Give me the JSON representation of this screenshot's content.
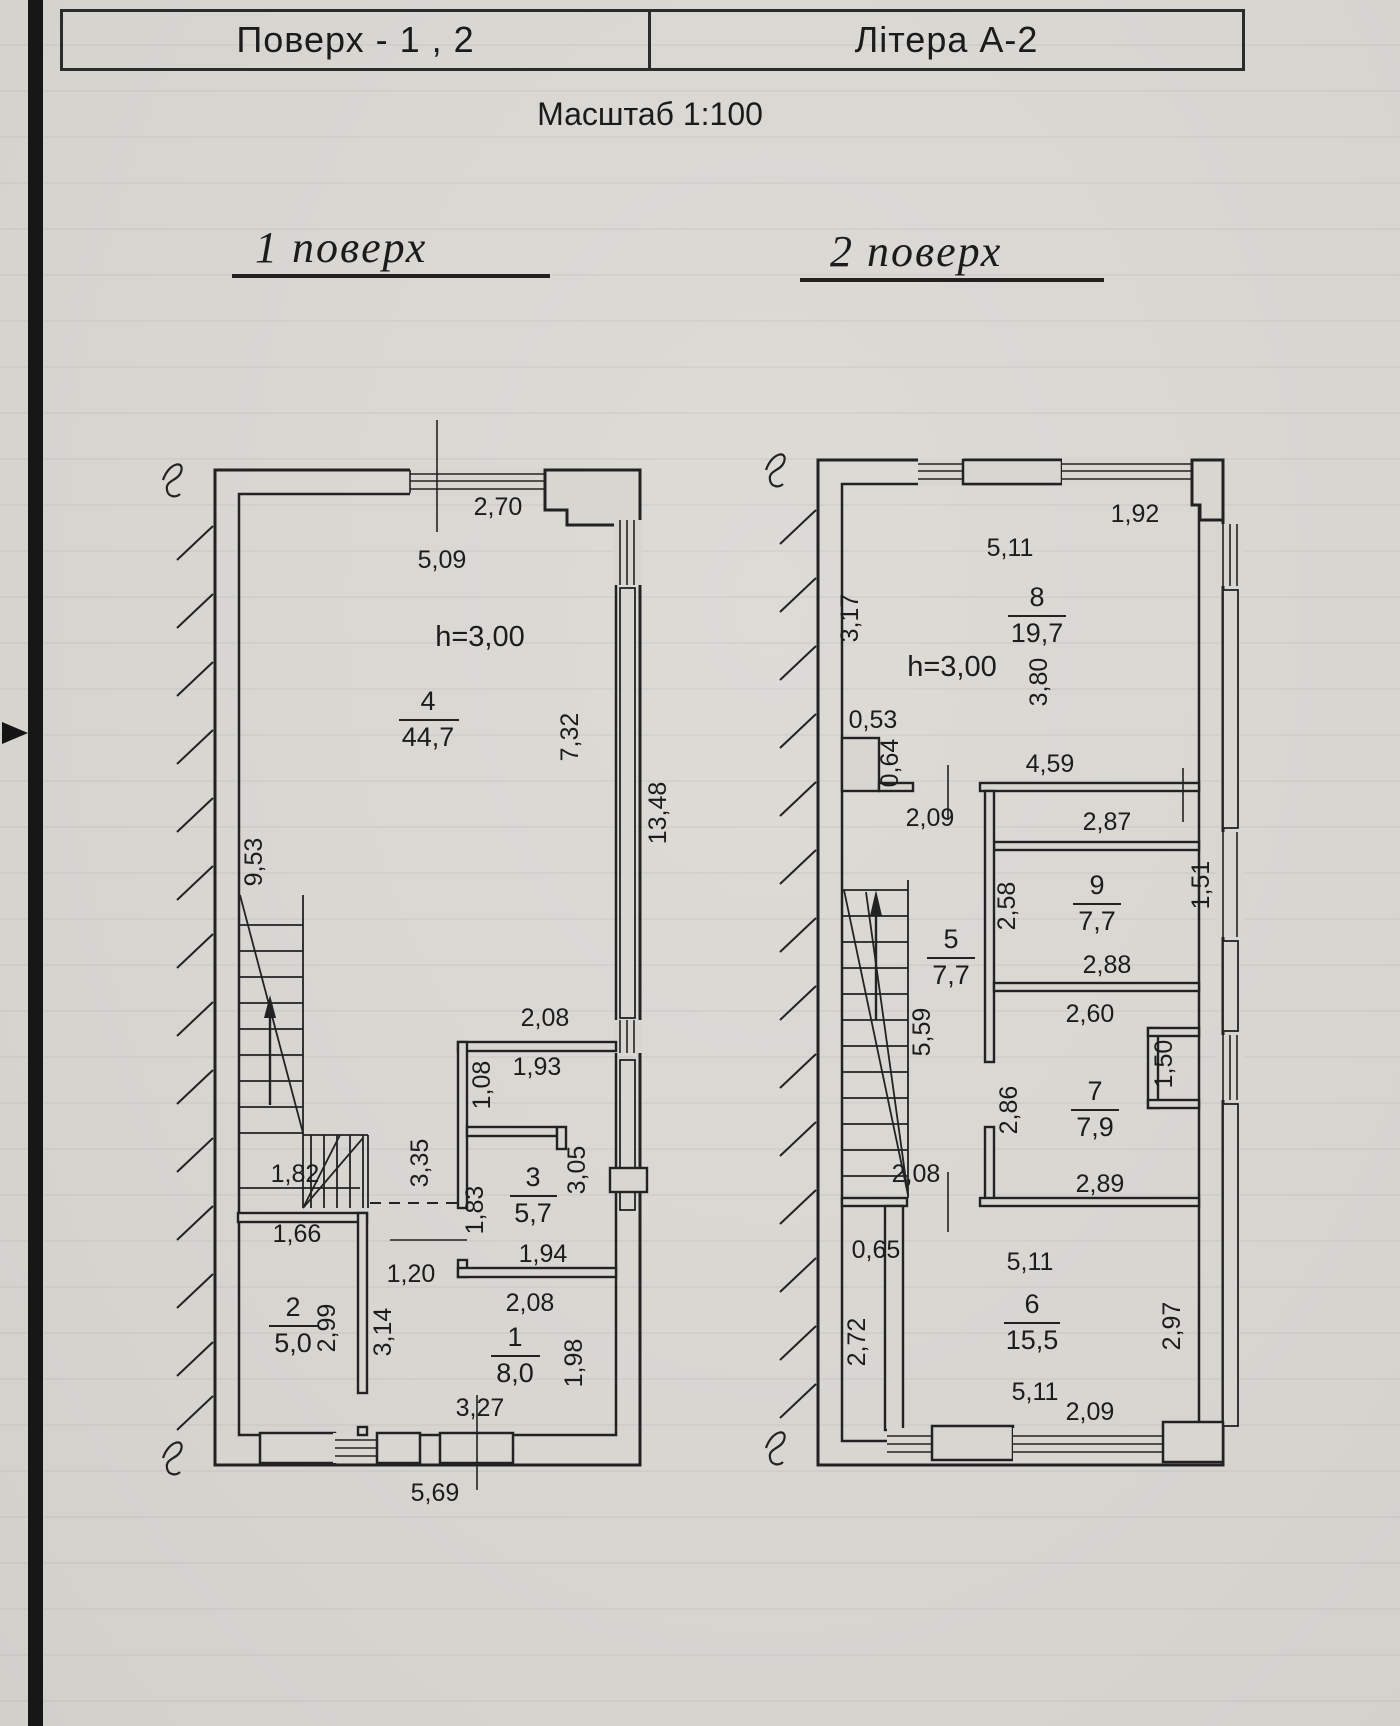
{
  "header": {
    "floors": "Поверх - 1 , 2",
    "letter": "Літера А-2"
  },
  "scale_note": "Масштаб 1:100",
  "floor1": {
    "title": "1 поверх",
    "height_note": "h=3,00",
    "rooms": {
      "r4": {
        "num": "4",
        "area": "44,7"
      },
      "r3": {
        "num": "3",
        "area": "5,7"
      },
      "r2": {
        "num": "2",
        "area": "5,0"
      },
      "r1": {
        "num": "1",
        "area": "8,0"
      }
    },
    "dims": {
      "top_window": "2,70",
      "top_width": "5,09",
      "stair_flight": "9,53",
      "right_mid": "7,32",
      "right_total": "13,48",
      "wc_block_top": "2,08",
      "closet_w": "1,93",
      "closet_h": "1,08",
      "hall_len": "3,35",
      "wc_left": "1,83",
      "wc_right": "3,05",
      "wc_bottom": "1,94",
      "hall_w": "1,20",
      "stair_landing": "1,82",
      "room2_top": "1,66",
      "room2_right": "2,99",
      "lobby_h": "3,14",
      "room1_top": "2,08",
      "room1_right": "1,98",
      "entry_w": "3,27",
      "bottom_width": "5,69"
    }
  },
  "floor2": {
    "title": "2 поверх",
    "height_note": "h=3,00",
    "rooms": {
      "r8": {
        "num": "8",
        "area": "19,7"
      },
      "r9": {
        "num": "9",
        "area": "7,7"
      },
      "r5": {
        "num": "5",
        "area": "7,7"
      },
      "r7": {
        "num": "7",
        "area": "7,9"
      },
      "r6": {
        "num": "6",
        "area": "15,5"
      }
    },
    "dims": {
      "top_window": "1,92",
      "room8_width": "5,11",
      "room8_h_right": "3,80",
      "room8_h_left": "3,17",
      "notch_w": "0,53",
      "notch_h": "0,64",
      "corridor_w": "4,59",
      "hall_top_w": "2,09",
      "room9_top": "2,87",
      "room9_h": "2,58",
      "room9_bottom": "2,88",
      "win_right_upper": "1,51",
      "room5_h": "5,59",
      "room7_top": "2,60",
      "room7_h": "2,86",
      "win_right_lower": "1,50",
      "room7_bottom": "2,89",
      "stair_w": "2,08",
      "step_w": "0,65",
      "room6_left": "2,72",
      "room6_top": "5,11",
      "room6_bottom": "5,11",
      "room6_right": "2,97",
      "bottom_window": "2,09"
    }
  }
}
